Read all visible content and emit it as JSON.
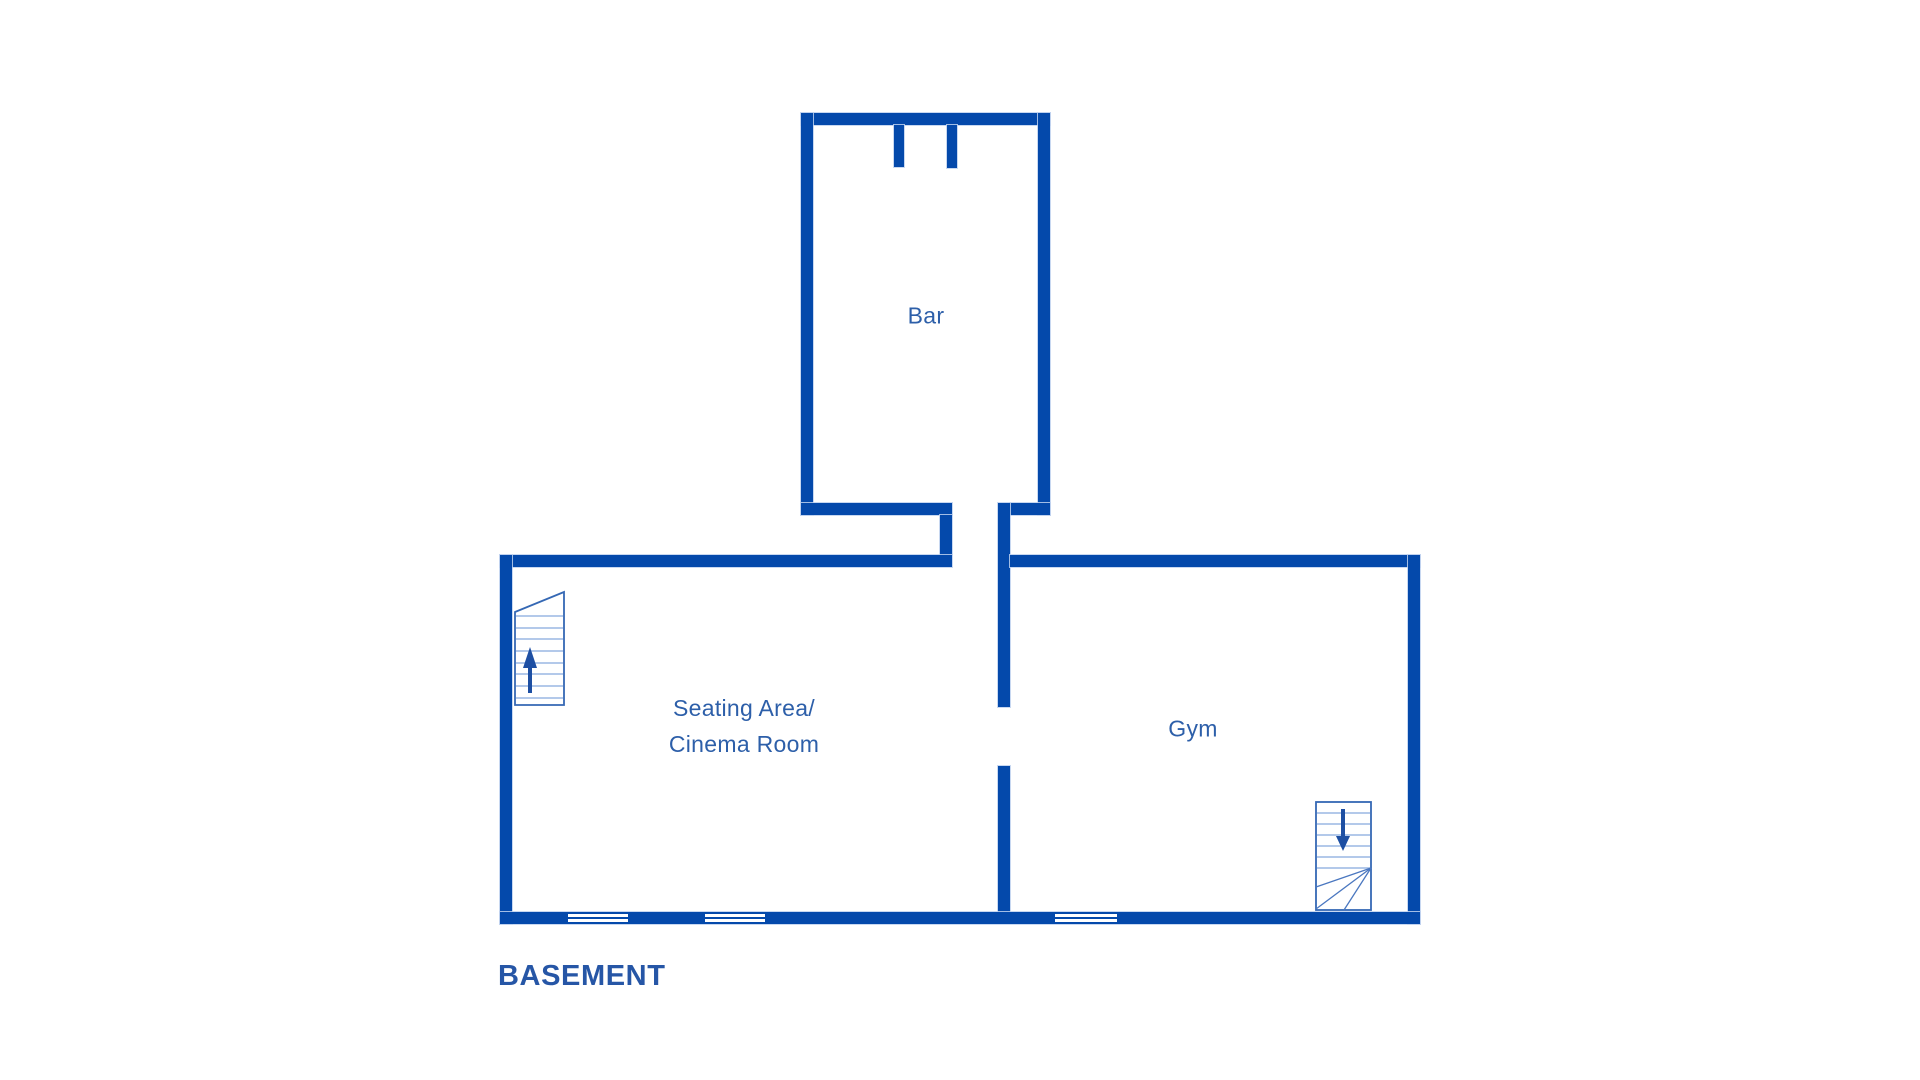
{
  "floor_title": "BASEMENT",
  "rooms": {
    "bar": {
      "label": "Bar"
    },
    "seating": {
      "label_line1": "Seating Area/",
      "label_line2": "Cinema Room"
    },
    "gym": {
      "label": "Gym"
    }
  },
  "features": {
    "window_count": 3,
    "staircase_up_location": "seating area, left wall",
    "staircase_down_location": "gym, bottom right",
    "door_openings": [
      "bar top wall",
      "bar to seating corridor",
      "seating to gym divider"
    ]
  },
  "colors": {
    "wall": "#0449ab",
    "room_label": "#2d5fa9",
    "floor_title": "#2656a6",
    "stair_outline": "#3568b4",
    "stair_steps": "#9ab7e3",
    "winder_lines": "#4a77c0",
    "arrow": "#1d4fa3"
  }
}
